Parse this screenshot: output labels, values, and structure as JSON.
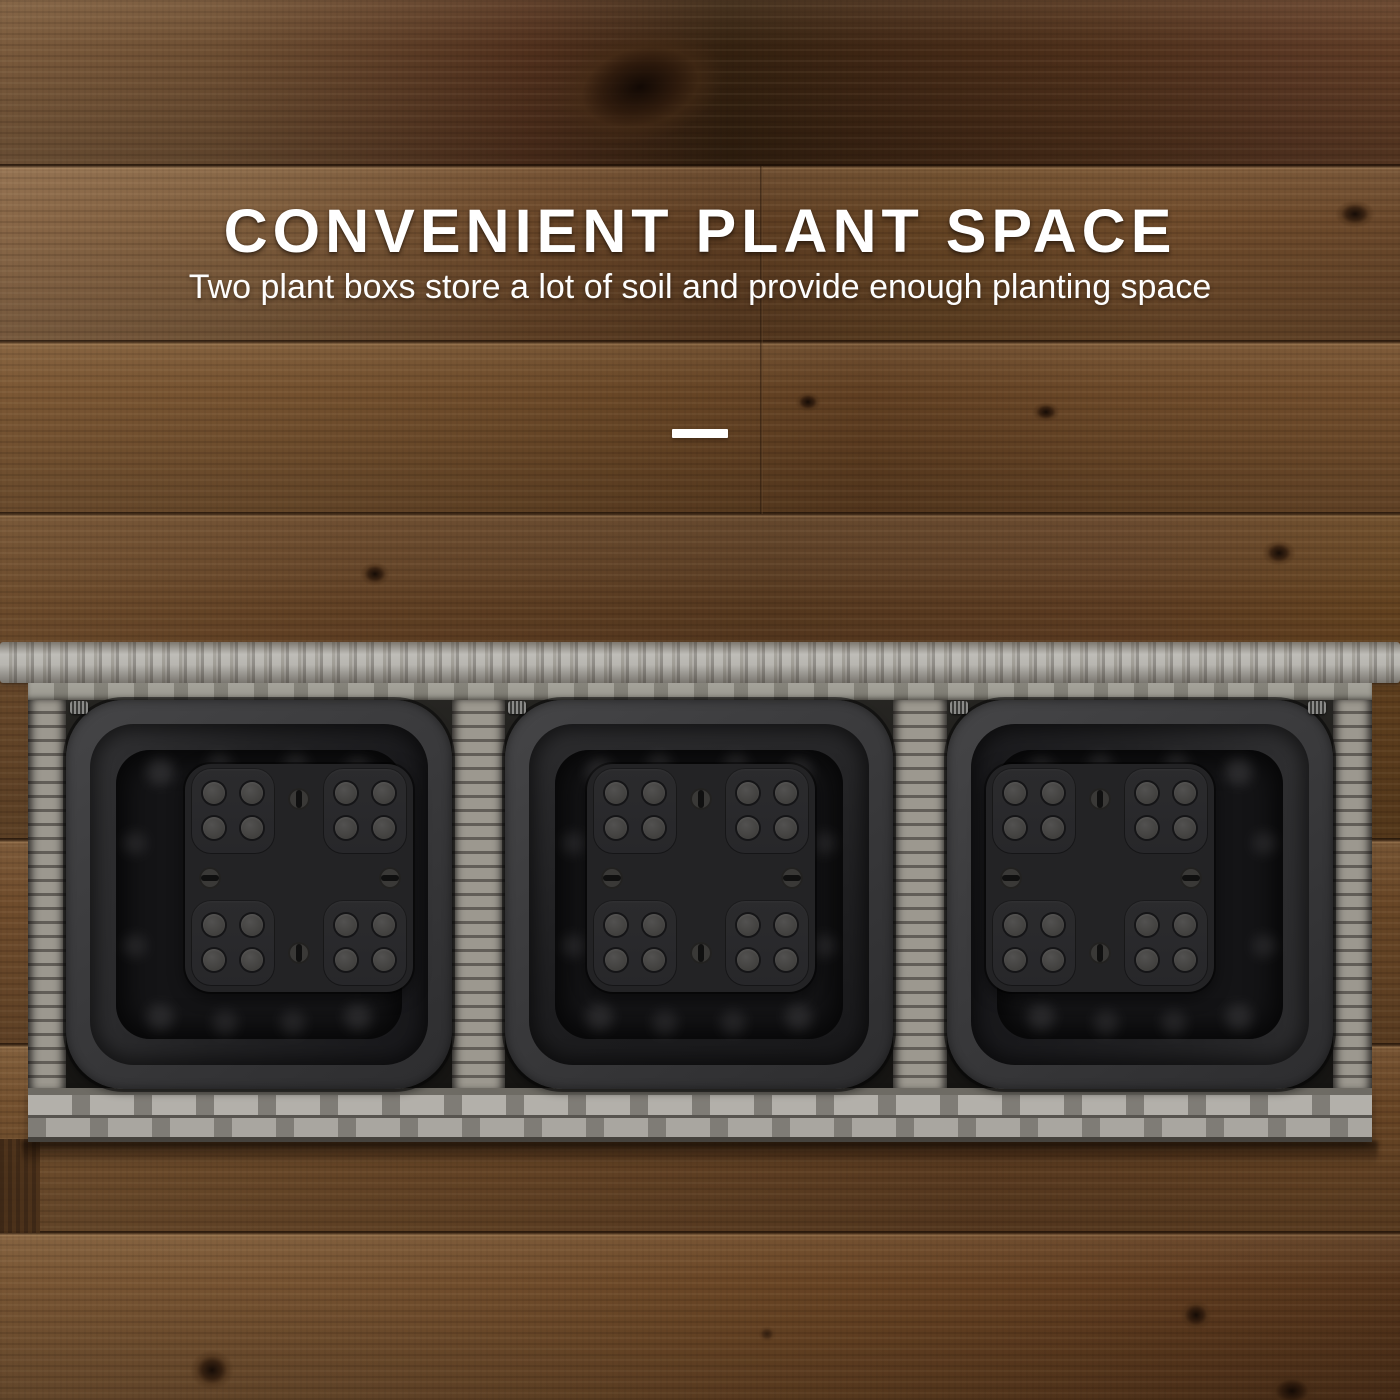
{
  "banner": {
    "headline": "CONVENIENT PLANT SPACE",
    "subheadline": "Two plant boxs store a lot of soil and provide enough planting space",
    "text_color": "#ffffff",
    "divider_color": "#ffffff"
  },
  "scene": {
    "subject": "top view of a grey rattan wicker planter box holding three black square grow pots, on dark brown wood planks",
    "pot_count": 3,
    "colors": {
      "wood_brown": "#5e3e23",
      "wood_dark": "#33200f",
      "wicker_grey": "#a5a29c",
      "wicker_shadow": "#625e58",
      "pot_black": "#2a2a2c",
      "pot_plate": "#232325"
    }
  }
}
